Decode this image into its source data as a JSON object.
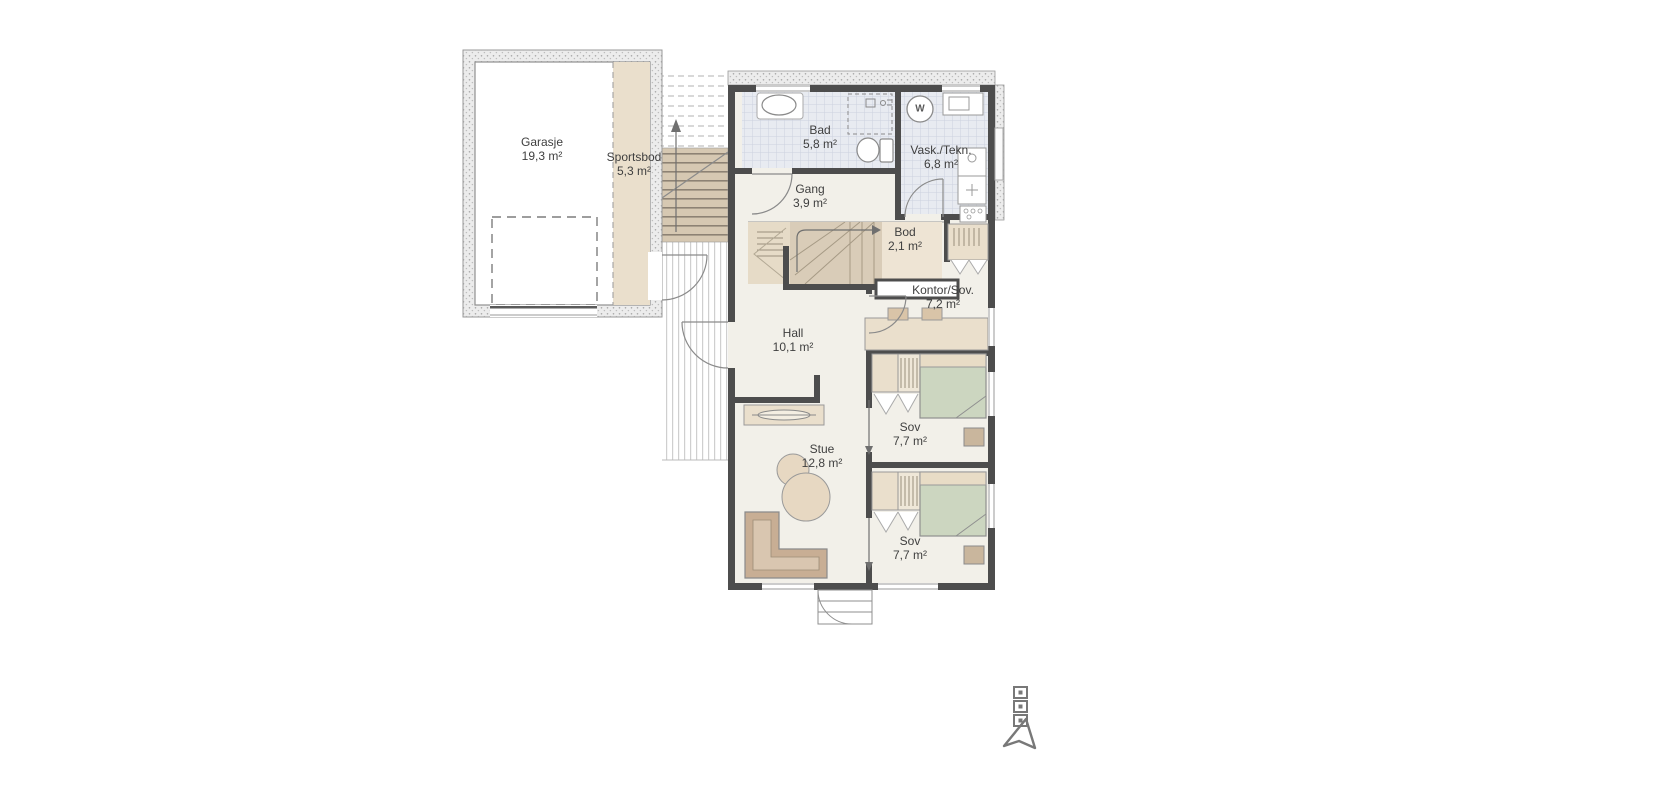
{
  "plan": {
    "rooms": [
      {
        "name": "Garasje",
        "area": "19,3 m²"
      },
      {
        "name": "Sportsbod",
        "area": "5,3 m²"
      },
      {
        "name": "Bad",
        "area": "5,8 m²"
      },
      {
        "name": "Gang",
        "area": "3,9 m²"
      },
      {
        "name": "Vask./Tekn.",
        "area": "6,8 m²"
      },
      {
        "name": "Bod",
        "area": "2,1 m²"
      },
      {
        "name": "Kontor/Sov.",
        "area": "7,2 m²"
      },
      {
        "name": "Hall",
        "area": "10,1 m²"
      },
      {
        "name": "Stue",
        "area": "12,8 m²"
      },
      {
        "name": "Sov",
        "area": "7,7 m²"
      },
      {
        "name": "Sov",
        "area": "7,7 m²"
      }
    ],
    "appliance_labels": {
      "washer": "W"
    },
    "colors": {
      "wall": "#4d4d4d",
      "beige": "#eadfcc",
      "stairFill": "#d9ccb8",
      "landing": "#e6dbc7",
      "floor": "#f2f0e9",
      "bedGreen": "#ccd6c0",
      "pillow": "#e8dcc6",
      "sofa": "#c8ae94",
      "sofaSeat": "#d9c6b0",
      "table": "#e7d8c2",
      "bedside": "#c9b69d",
      "deskTop": "#d9c4a8",
      "lineGrey": "#8a8a8a"
    }
  }
}
